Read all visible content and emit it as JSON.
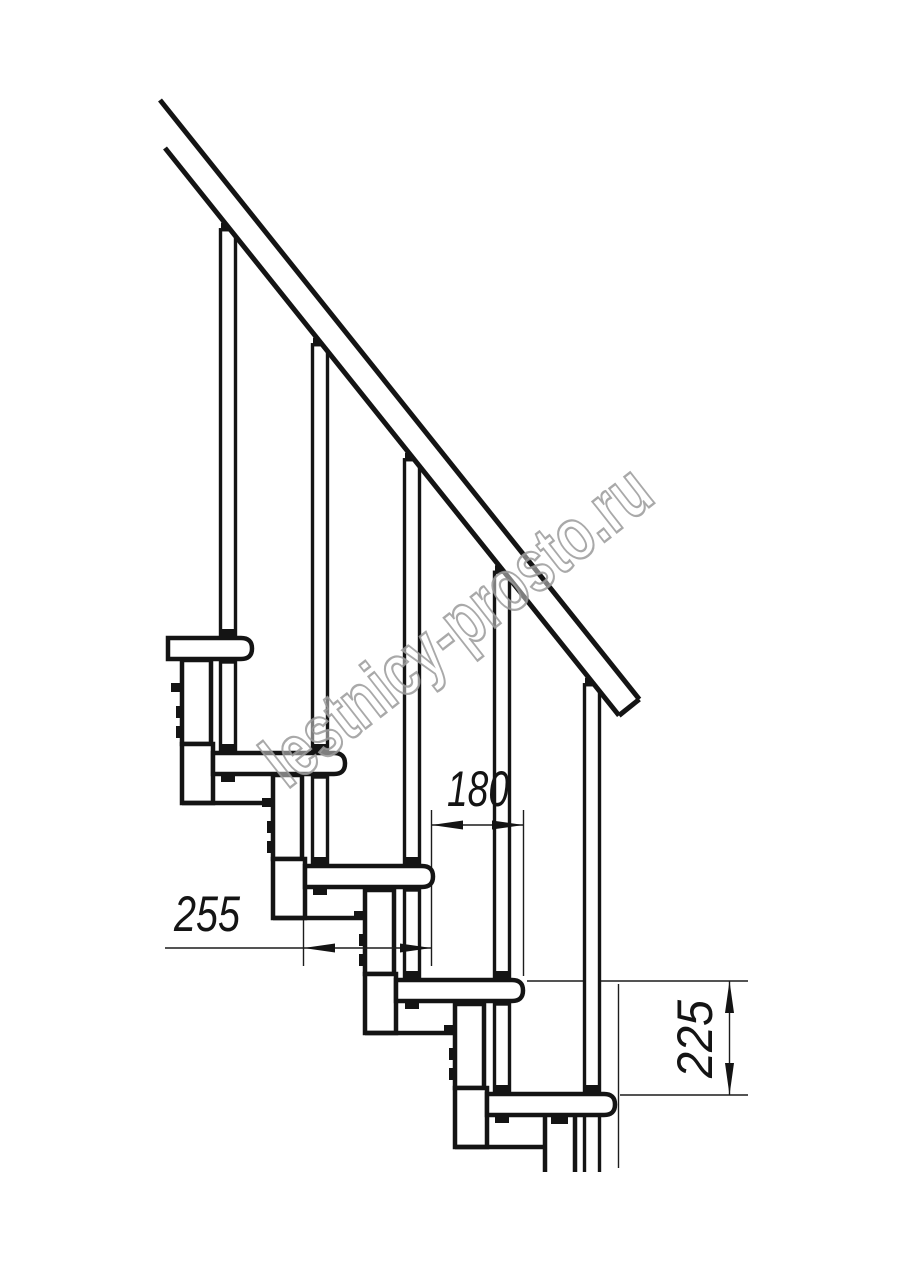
{
  "drawing": {
    "kind": "modular-staircase-side-view",
    "steps_visible": 5,
    "balusters_visible": 5
  },
  "dimensions": {
    "tread_depth": {
      "value": "255"
    },
    "step_run": {
      "value": "180"
    },
    "step_rise": {
      "value": "225"
    }
  },
  "watermark": {
    "text": "lestnicy-prosto.ru"
  },
  "colors": {
    "line": "#141414",
    "watermark_outline": "#9a9a9a",
    "background": "#ffffff"
  }
}
